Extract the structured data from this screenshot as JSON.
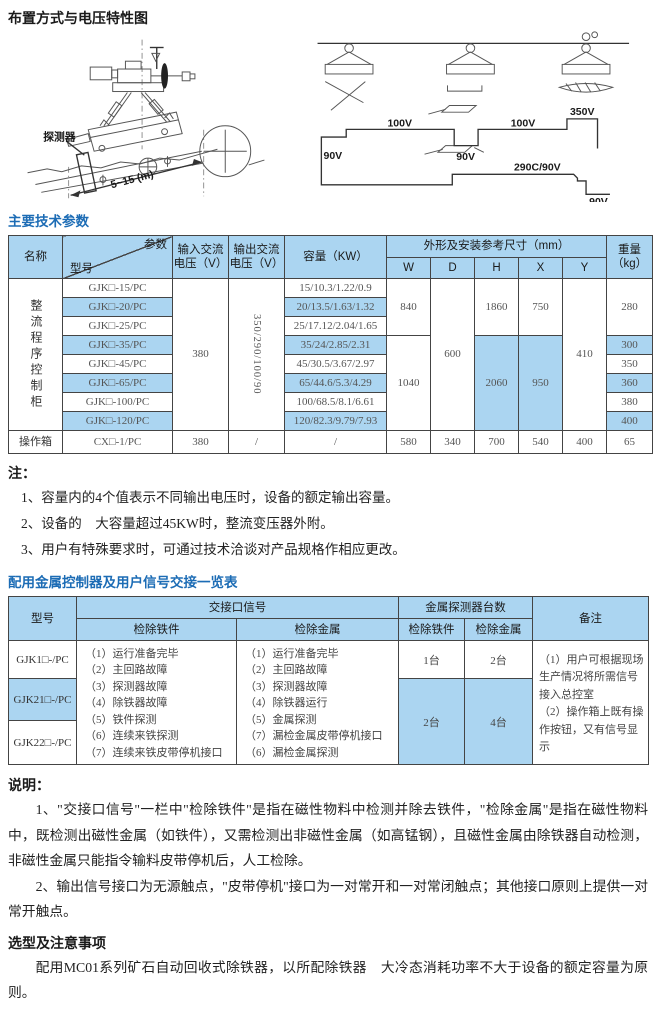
{
  "titles": {
    "layout": "布置方式与电压特性图",
    "params": "主要技术参数",
    "notes": "注：",
    "signal_table": "配用金属控制器及用户信号交接一览表",
    "explanation": "说明：",
    "selection": "选型及注意事项"
  },
  "diagram_left": {
    "detector": "探测器",
    "dimension": "5~15 (m)"
  },
  "diagram_right": {
    "v100a": "100V",
    "v100b": "100V",
    "v350": "350V",
    "v90a": "90V",
    "v90b": "90V",
    "v290": "290C/90V",
    "v90c": "90V"
  },
  "table1": {
    "corner": {
      "param": "参数",
      "model": "型号"
    },
    "headers": {
      "name": "名称",
      "vin": "输入交流\n电压（V）",
      "vout": "输出交流\n电压（V）",
      "capacity": "容量（KW）",
      "dims": "外形及安装参考尺寸（mm）",
      "w": "W",
      "d": "D",
      "h": "H",
      "x": "X",
      "y": "Y",
      "weight": "重量\n（kg）"
    },
    "group_name": "整流程序控制柜",
    "vin": "380",
    "vout": "350/290/100/90",
    "d": "600",
    "y": "410",
    "w1": "840",
    "h1": "1860",
    "x1": "750",
    "weight1": "280",
    "w2": "1040",
    "h2": "2060",
    "x2": "950",
    "rows": [
      {
        "model": "GJK□-15/PC",
        "capacity": "15/10.3/1.22/0.9"
      },
      {
        "model": "GJK□-20/PC",
        "capacity": "20/13.5/1.63/1.32"
      },
      {
        "model": "GJK□-25/PC",
        "capacity": "25/17.12/2.04/1.65"
      },
      {
        "model": "GJK□-35/PC",
        "capacity": "35/24/2.85/2.31",
        "weight": "300"
      },
      {
        "model": "GJK□-45/PC",
        "capacity": "45/30.5/3.67/2.97",
        "weight": "350"
      },
      {
        "model": "GJK□-65/PC",
        "capacity": "65/44.6/5.3/4.29",
        "weight": "360"
      },
      {
        "model": "GJK□-100/PC",
        "capacity": "100/68.5/8.1/6.61",
        "weight": "380"
      },
      {
        "model": "GJK□-120/PC",
        "capacity": "120/82.3/9.79/7.93",
        "weight": "400"
      }
    ],
    "bottom": {
      "name": "操作箱",
      "model": "CX□-1/PC",
      "vin": "380",
      "vout": "/",
      "capacity": "/",
      "w": "580",
      "d": "340",
      "h": "700",
      "x": "540",
      "y": "400",
      "weight": "65"
    }
  },
  "notes_items": [
    "1、容量内的4个值表示不同输出电压时，设备的额定输出容量。",
    "2、设备的　大容量超过45KW时，整流变压器外附。",
    "3、用户有特殊要求时，可通过技术洽谈对产品规格作相应更改。"
  ],
  "table2": {
    "headers": {
      "model": "型号",
      "signals": "交接口信号",
      "iron": "检除铁件",
      "metal": "检除金属",
      "detectors": "金属探测器台数",
      "iron2": "检除铁件",
      "metal2": "检除金属",
      "remark": "备注"
    },
    "models": [
      "GJK1□-/PC",
      "GJK21□-/PC",
      "GJK22□-/PC"
    ],
    "iron_signals": [
      "（1）运行准备完毕",
      "（2）主回路故障",
      "（3）探测器故障",
      "（4）除铁器故障",
      "（5）铁件探测",
      "（6）连续来铁探测",
      "（7）连续来铁皮带停机接口"
    ],
    "metal_signals": [
      "（1）运行准备完毕",
      "（2）主回路故障",
      "（3）探测器故障",
      "（4）除铁器运行",
      "（5）金属探测",
      "（7）漏检金属皮带停机接口",
      "（6）漏检金属探测"
    ],
    "counts": {
      "r1_iron": "1台",
      "r1_metal": "2台",
      "r23_iron": "2台",
      "r23_metal": "4台"
    },
    "remark": [
      "（1）用户可根据现场生产情况将所需信号接入总控室",
      "（2）操作箱上既有操作按钮，又有信号显示"
    ]
  },
  "explanation": {
    "para1": "1、\"交接口信号\"一栏中\"检除铁件\"是指在磁性物料中检测并除去铁件，\"检除金属\"是指在磁性物料中，既检测出磁性金属（如铁件），又需检测出非磁性金属（如高锰钢），且磁性金属由除铁器自动检测，非磁性金属只能指令输料皮带停机后，人工检除。",
    "para2": "2、输出信号接口为无源触点，\"皮带停机\"接口为一对常开和一对常闭触点；其他接口原则上提供一对常开触点。"
  },
  "selection_para": "配用MC01系列矿石自动回收式除铁器，以所配除铁器　大冷态消耗功率不大于设备的额定容量为原则。"
}
